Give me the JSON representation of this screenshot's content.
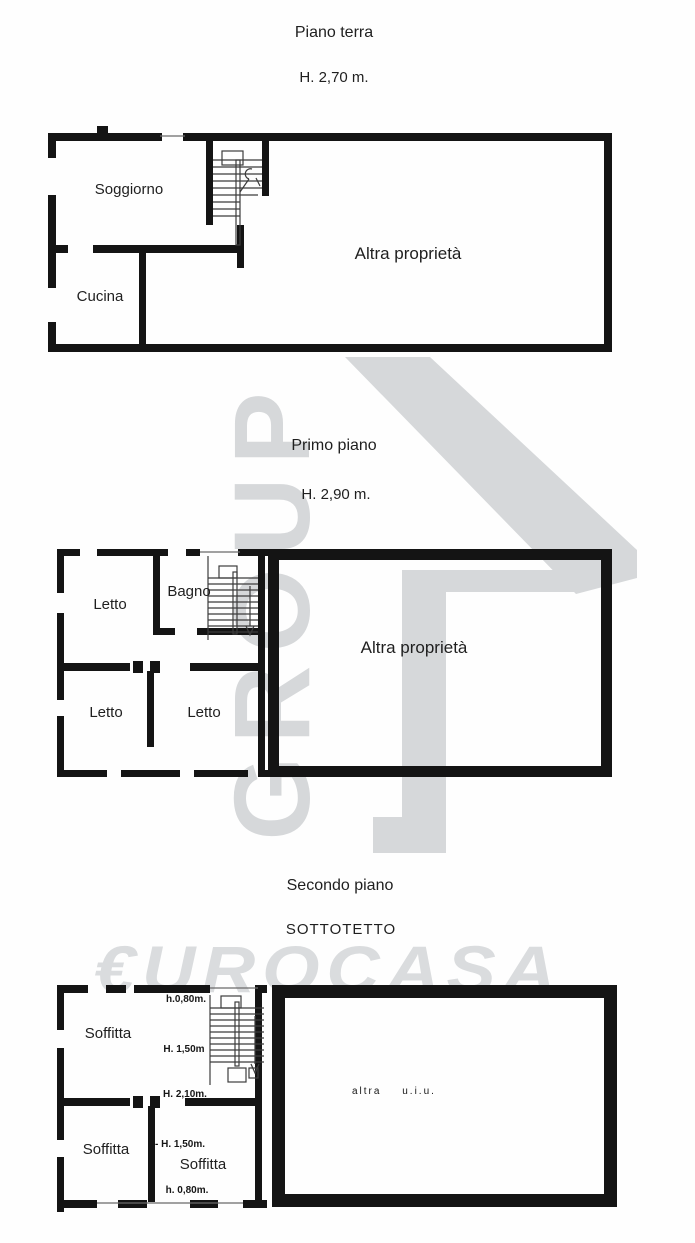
{
  "watermark": {
    "group_text": "GROUP",
    "brand_text": "€UROCASA",
    "color": "#d6d8da"
  },
  "floors": {
    "terra": {
      "title": "Piano terra",
      "ceiling_height": "H. 2,70 m.",
      "rooms": {
        "soggiorno": "Soggiorno",
        "cucina": "Cucina",
        "altra_proprieta": "Altra proprietà"
      }
    },
    "primo": {
      "title": "Primo piano",
      "ceiling_height": "H. 2,90 m.",
      "rooms": {
        "letto_nw": "Letto",
        "bagno": "Bagno",
        "letto_sw": "Letto",
        "letto_s": "Letto",
        "altra_proprieta": "Altra proprietà"
      }
    },
    "secondo": {
      "title": "Secondo piano",
      "subtitle": "SOTTOTETTO",
      "rooms": {
        "soffitta_nw": "Soffitta",
        "soffitta_sw": "Soffitta",
        "soffitta_s": "Soffitta",
        "altra_uiu": "altra u.i.u."
      },
      "height_labels": {
        "top": "h.0,80m.",
        "mid_upper": "H. 1,50m",
        "mid": "H. 2,10m.",
        "mid_lower": "- H. 1,50m.",
        "bottom": "h. 0,80m."
      }
    }
  }
}
